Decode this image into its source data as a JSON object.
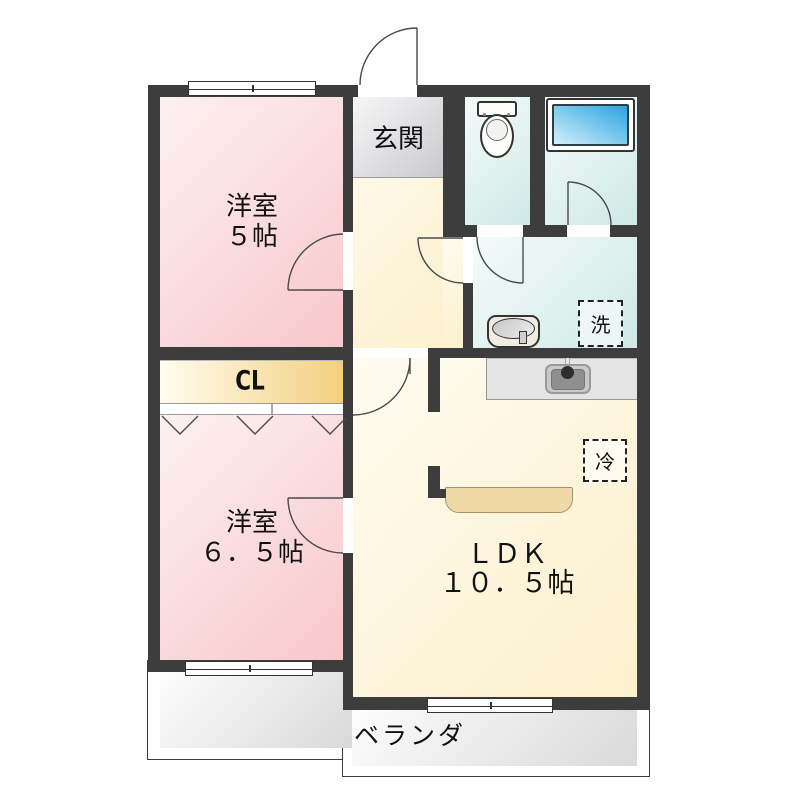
{
  "rooms": {
    "entrance": {
      "label": "玄関"
    },
    "western_room_5": {
      "name": "洋室",
      "size": "５帖"
    },
    "closet": {
      "label": "CL"
    },
    "western_room_6_5": {
      "name": "洋室",
      "size": "６．５帖"
    },
    "ldk": {
      "name": "ＬＤＫ",
      "size": "１０．５帖"
    },
    "veranda": {
      "label": "ベランダ"
    }
  },
  "appliances": {
    "washing_machine": "洗",
    "refrigerator": "冷"
  },
  "colors": {
    "wall": "#3d3d3d",
    "room_pink": "#f8c7cb",
    "room_pink_light": "#fdf1f1",
    "cream": "#fcf0cc",
    "cream_light": "#fefbf0",
    "closet_yellow": "#f3cf7e",
    "closet_yellow_light": "#fffdf0",
    "entrance_gray": "#c9c9cd",
    "entrance_gray_light": "#f7f7f7",
    "wet_teal": "#cfe9e6",
    "wet_teal_light": "#f4fbf9",
    "tub_blue": "#2aa4e1",
    "tub_blue_light": "#d3effa",
    "veranda_gray": "#d9d9d9",
    "counter_tan": "#eed9a7"
  }
}
